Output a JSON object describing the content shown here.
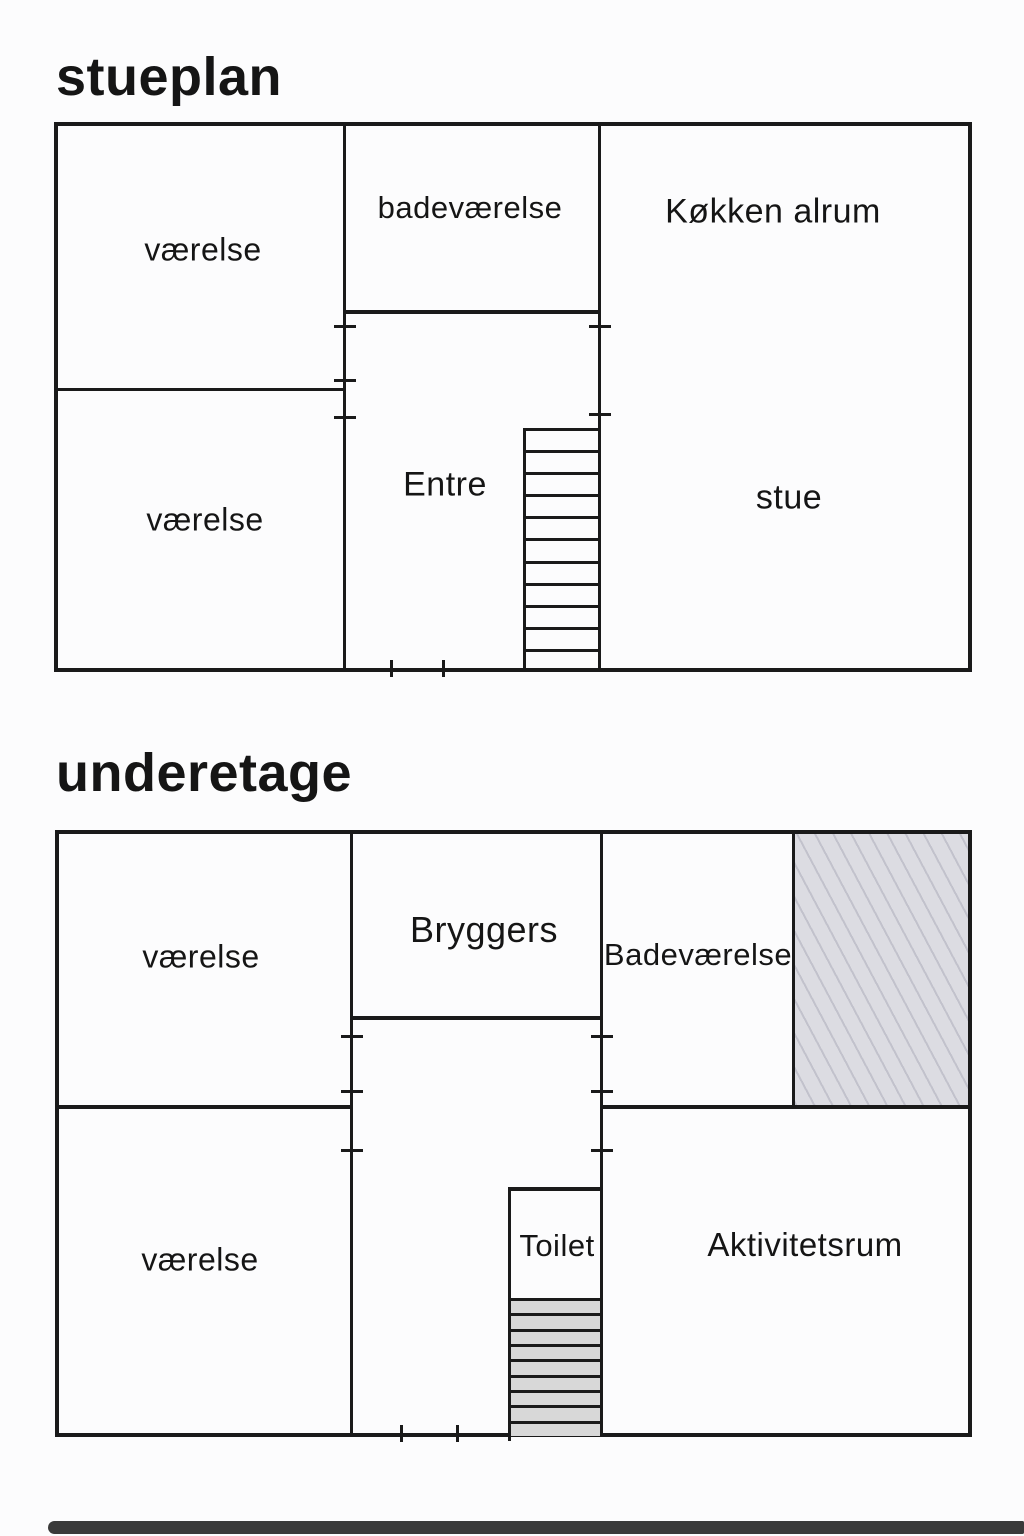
{
  "colors": {
    "wall": "#1a1a1a",
    "text": "#151515",
    "background": "#fcfcfd",
    "hatch_fill": "#dcdce2",
    "hatch_line": "#c2c2cc",
    "stair_fill": "#d8d8d8",
    "scan_strip": "#3a3a3a"
  },
  "plans": [
    {
      "title": "stueplan",
      "rooms": [
        {
          "label": "værelse"
        },
        {
          "label": "badeværelse"
        },
        {
          "label": "Køkken alrum"
        },
        {
          "label": "værelse"
        },
        {
          "label": "Entre"
        },
        {
          "label": "stue"
        }
      ],
      "stairs": {
        "treads": 11
      }
    },
    {
      "title": "underetage",
      "rooms": [
        {
          "label": "værelse"
        },
        {
          "label": "Bryggers"
        },
        {
          "label": "Badeværelse"
        },
        {
          "label": "værelse"
        },
        {
          "label": "Toilet"
        },
        {
          "label": "Aktivitetsrum"
        }
      ],
      "stairs": {
        "treads": 9
      }
    }
  ]
}
